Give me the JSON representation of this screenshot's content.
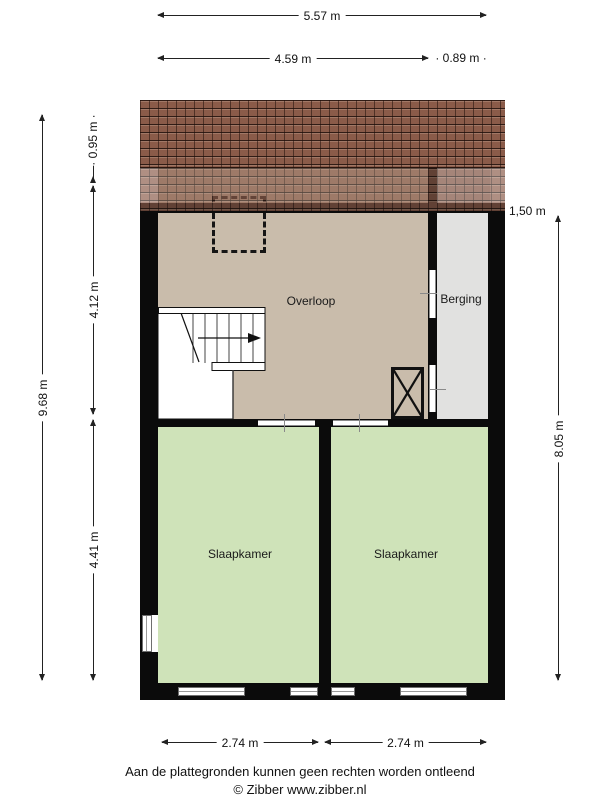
{
  "rooms": {
    "overloop": "Overloop",
    "berging": "Berging",
    "slaapkamer_left": "Slaapkamer",
    "slaapkamer_right": "Slaapkamer"
  },
  "dimensions": {
    "top_total": "5.57 m",
    "top_left": "4.59 m",
    "top_right": "0.89 m",
    "left_total": "9.68 m",
    "left_roof": "0.95 m",
    "left_mid": "4.12 m",
    "left_bottom": "4.41 m",
    "right_height": "1,50 m",
    "right_total": "8.05 m",
    "bottom_left": "2.74 m",
    "bottom_right": "2.74 m"
  },
  "decor": {
    "dot": "·"
  },
  "footer": {
    "disclaimer": "Aan de plattegronden kunnen geen rechten worden ontleend",
    "credit": "© Zibber www.zibber.nl"
  },
  "colors": {
    "wall": "#0b0b0b",
    "floor_landing": "#c9bcab",
    "floor_bedroom": "#cfe3b9",
    "floor_storage": "#e1e1e0",
    "roof": "#8a5b49"
  }
}
